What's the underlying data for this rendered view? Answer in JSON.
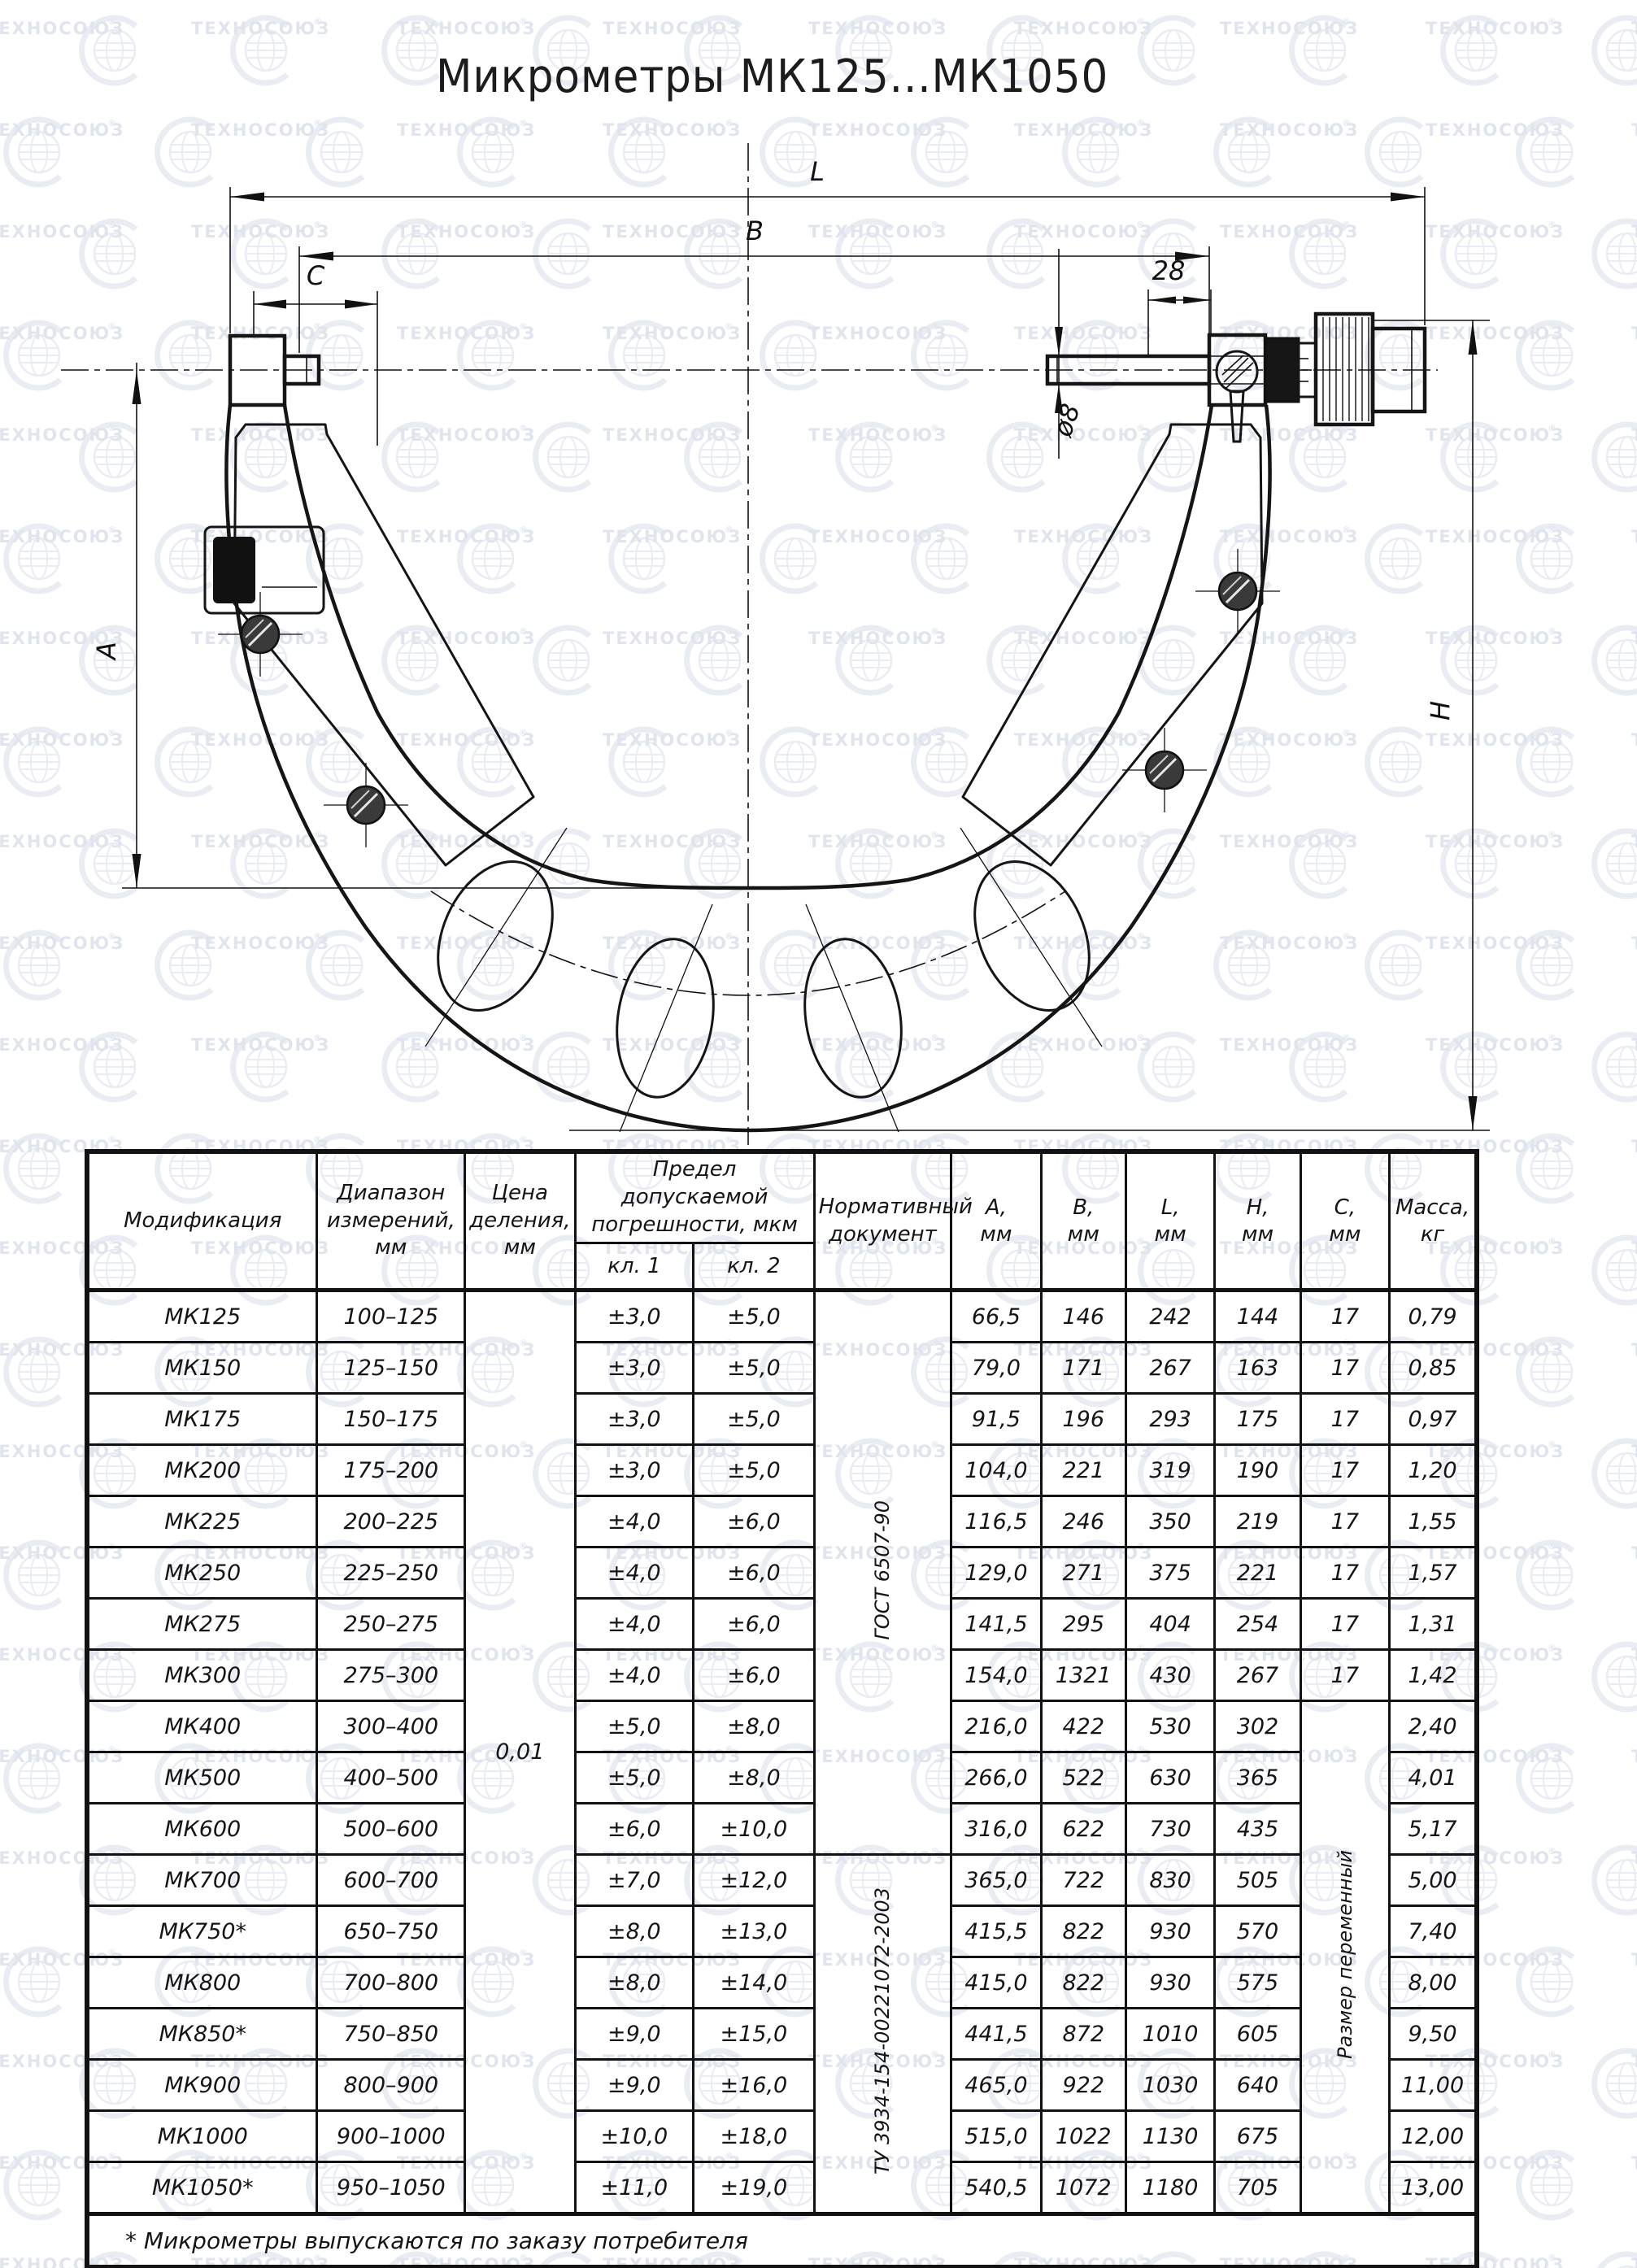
{
  "watermark": {
    "text": "ТЕХНОСОЮЗ",
    "reg": "®"
  },
  "page": {
    "title": "Микрометры МК125...МК1050"
  },
  "drawing": {
    "labels": {
      "L": "L",
      "B": "B",
      "C": "C",
      "len28": "28",
      "dia8": "ø8",
      "A": "A",
      "H": "H"
    }
  },
  "table": {
    "header": {
      "modification": "Модификация",
      "range": "Диапазон измерений, мм",
      "division": "Цена деления, мм",
      "error_limit": "Предел допускаемой погрешности, мкм",
      "cl1": "кл. 1",
      "cl2": "кл. 2",
      "norm": "Нормативный документ",
      "cols": [
        {
          "l": "А,",
          "u": "мм"
        },
        {
          "l": "В,",
          "u": "мм"
        },
        {
          "l": "L,",
          "u": "мм"
        },
        {
          "l": "Н,",
          "u": "мм"
        },
        {
          "l": "С,",
          "u": "мм"
        },
        {
          "l": "Масса,",
          "u": "кг"
        }
      ]
    },
    "merged": {
      "division_value": "0,01",
      "norm1": "ГОСТ 6507-90",
      "norm2": "ТУ 3934-154-00221072-2003",
      "c_note": "Размер переменный"
    },
    "rows": [
      {
        "mod": "МК125",
        "range": "100–125",
        "cl1": "±3,0",
        "cl2": "±5,0",
        "a": "66,5",
        "b": "146",
        "l": "242",
        "h": "144",
        "c": "17",
        "mass": "0,79"
      },
      {
        "mod": "МК150",
        "range": "125–150",
        "cl1": "±3,0",
        "cl2": "±5,0",
        "a": "79,0",
        "b": "171",
        "l": "267",
        "h": "163",
        "c": "17",
        "mass": "0,85"
      },
      {
        "mod": "МК175",
        "range": "150–175",
        "cl1": "±3,0",
        "cl2": "±5,0",
        "a": "91,5",
        "b": "196",
        "l": "293",
        "h": "175",
        "c": "17",
        "mass": "0,97"
      },
      {
        "mod": "МК200",
        "range": "175–200",
        "cl1": "±3,0",
        "cl2": "±5,0",
        "a": "104,0",
        "b": "221",
        "l": "319",
        "h": "190",
        "c": "17",
        "mass": "1,20"
      },
      {
        "mod": "МК225",
        "range": "200–225",
        "cl1": "±4,0",
        "cl2": "±6,0",
        "a": "116,5",
        "b": "246",
        "l": "350",
        "h": "219",
        "c": "17",
        "mass": "1,55"
      },
      {
        "mod": "МК250",
        "range": "225–250",
        "cl1": "±4,0",
        "cl2": "±6,0",
        "a": "129,0",
        "b": "271",
        "l": "375",
        "h": "221",
        "c": "17",
        "mass": "1,57"
      },
      {
        "mod": "МК275",
        "range": "250–275",
        "cl1": "±4,0",
        "cl2": "±6,0",
        "a": "141,5",
        "b": "295",
        "l": "404",
        "h": "254",
        "c": "17",
        "mass": "1,31"
      },
      {
        "mod": "МК300",
        "range": "275–300",
        "cl1": "±4,0",
        "cl2": "±6,0",
        "a": "154,0",
        "b": "1321",
        "l": "430",
        "h": "267",
        "c": "17",
        "mass": "1,42"
      },
      {
        "mod": "МК400",
        "range": "300–400",
        "cl1": "±5,0",
        "cl2": "±8,0",
        "a": "216,0",
        "b": "422",
        "l": "530",
        "h": "302",
        "c": "",
        "mass": "2,40"
      },
      {
        "mod": "МК500",
        "range": "400–500",
        "cl1": "±5,0",
        "cl2": "±8,0",
        "a": "266,0",
        "b": "522",
        "l": "630",
        "h": "365",
        "c": "",
        "mass": "4,01"
      },
      {
        "mod": "МК600",
        "range": "500–600",
        "cl1": "±6,0",
        "cl2": "±10,0",
        "a": "316,0",
        "b": "622",
        "l": "730",
        "h": "435",
        "c": "",
        "mass": "5,17"
      },
      {
        "mod": "МК700",
        "range": "600–700",
        "cl1": "±7,0",
        "cl2": "±12,0",
        "a": "365,0",
        "b": "722",
        "l": "830",
        "h": "505",
        "c": "",
        "mass": "5,00"
      },
      {
        "mod": "МК750*",
        "range": "650–750",
        "cl1": "±8,0",
        "cl2": "±13,0",
        "a": "415,5",
        "b": "822",
        "l": "930",
        "h": "570",
        "c": "",
        "mass": "7,40"
      },
      {
        "mod": "МК800",
        "range": "700–800",
        "cl1": "±8,0",
        "cl2": "±14,0",
        "a": "415,0",
        "b": "822",
        "l": "930",
        "h": "575",
        "c": "",
        "mass": "8,00"
      },
      {
        "mod": "МК850*",
        "range": "750–850",
        "cl1": "±9,0",
        "cl2": "±15,0",
        "a": "441,5",
        "b": "872",
        "l": "1010",
        "h": "605",
        "c": "",
        "mass": "9,50"
      },
      {
        "mod": "МК900",
        "range": "800–900",
        "cl1": "±9,0",
        "cl2": "±16,0",
        "a": "465,0",
        "b": "922",
        "l": "1030",
        "h": "640",
        "c": "",
        "mass": "11,00"
      },
      {
        "mod": "МК1000",
        "range": "900–1000",
        "cl1": "±10,0",
        "cl2": "±18,0",
        "a": "515,0",
        "b": "1022",
        "l": "1130",
        "h": "675",
        "c": "",
        "mass": "12,00"
      },
      {
        "mod": "МК1050*",
        "range": "950–1050",
        "cl1": "±11,0",
        "cl2": "±19,0",
        "a": "540,5",
        "b": "1072",
        "l": "1180",
        "h": "705",
        "c": "",
        "mass": "13,00"
      }
    ],
    "footnote": "* Микрометры выпускаются по заказу потребителя"
  }
}
